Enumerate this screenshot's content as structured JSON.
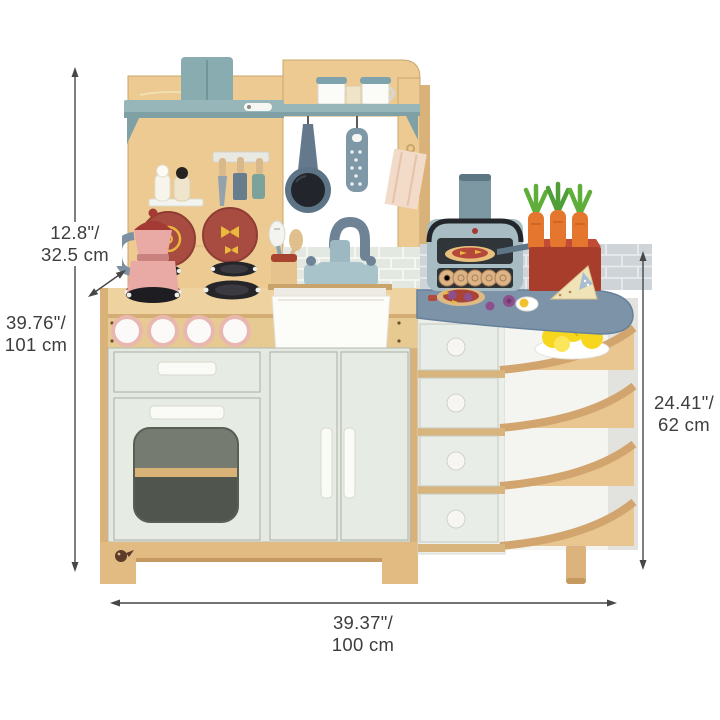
{
  "labels": {
    "hutch_depth": {
      "line1": "12.8\"/",
      "line2": "32.5 cm"
    },
    "overall_height": {
      "line1": "39.76\"/",
      "line2": "101 cm"
    },
    "side_unit_height": {
      "line1": "24.41\"/",
      "line2": "62 cm"
    },
    "overall_width": {
      "line1": "39.37\"/",
      "line2": "100 cm"
    }
  },
  "palette": {
    "background": "#ffffff",
    "annotation_text": "#3d3d3d",
    "dimension_line": "#474747",
    "wood_light": "#ecca92",
    "wood_mid": "#d9b279",
    "cabinet_sage": "#e4e9e1",
    "hood_blue": "#96b6ba",
    "counter_slate": "#7d93a8",
    "oven_blue": "#a7bdc3",
    "accent_red": "#a84b40",
    "coffee_pot_pink": "#e9a9a5",
    "carrot_orange": "#e5762e",
    "carrot_green": "#5fae3a",
    "lemon_yellow": "#f7d61e",
    "towel_pink": "#f3dbc9"
  }
}
